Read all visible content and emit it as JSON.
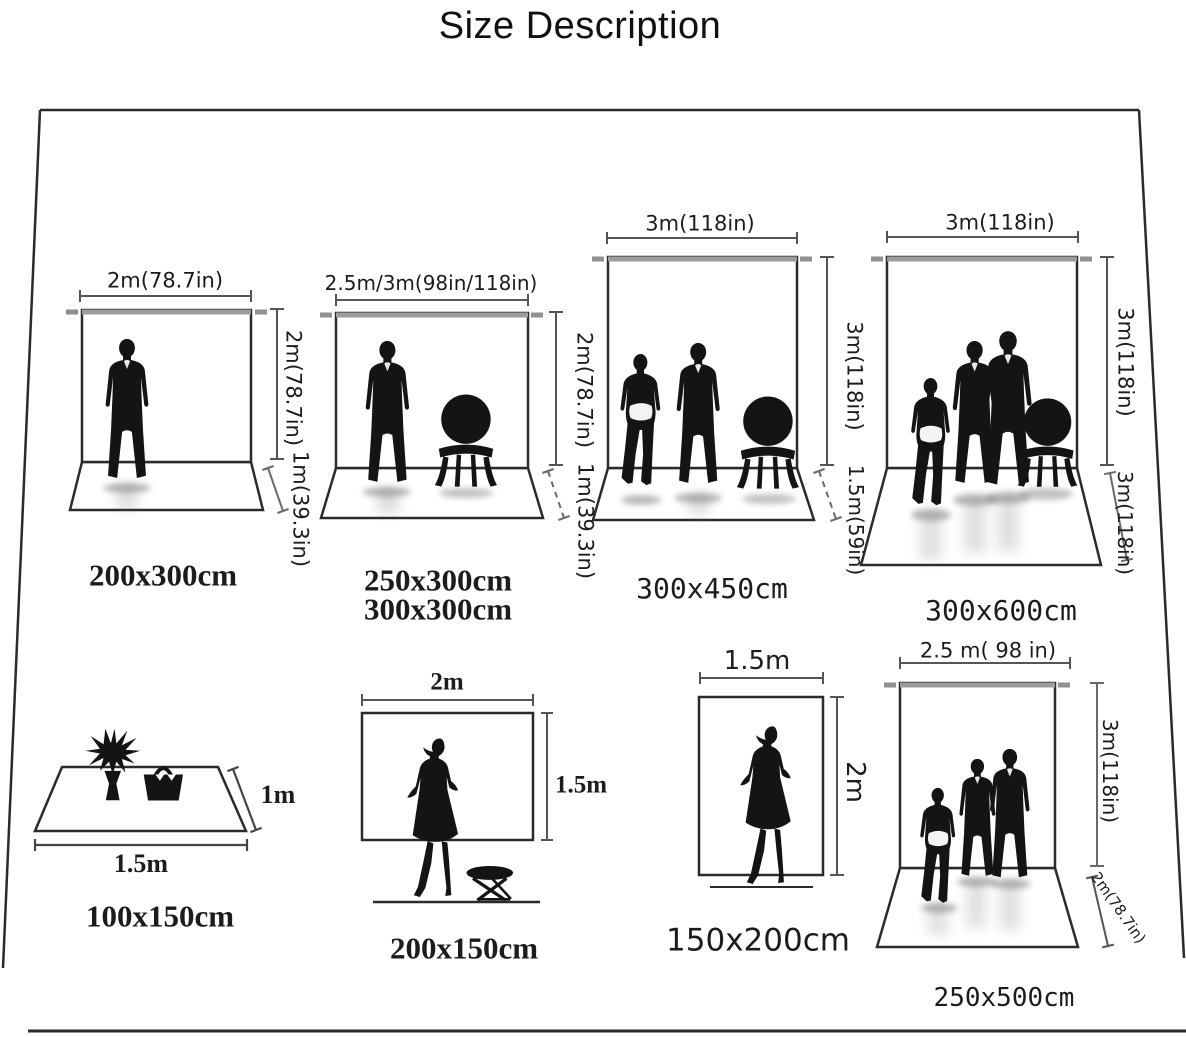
{
  "title": "Size Description",
  "colors": {
    "text": "#1c1c1c",
    "outline": "#2b2b2b",
    "dim_line": "#5a5a5a",
    "rod_gray": "#9c9c9c"
  },
  "diagrams": {
    "d1": {
      "width_label": "2m(78.7in)",
      "height_label": "2m(78.7in)",
      "floor_label": "1m(39.3in)",
      "size_label": "200x300cm"
    },
    "d2": {
      "width_label": "2.5m/3m(98in/118in)",
      "height_label": "2m(78.7in)",
      "floor_label": "1m(39.3in)",
      "size_label_1": "250x300cm",
      "size_label_2": "300x300cm"
    },
    "d3": {
      "width_label": "3m(118in)",
      "height_label": "3m(118in)",
      "floor_label": "1.5m(59in)",
      "size_label": "300x450cm"
    },
    "d4": {
      "width_label": "3m(118in)",
      "height_label": "3m(118in)",
      "floor_label": "3m(118in)",
      "size_label": "300x600cm"
    },
    "d5": {
      "width_label": "1.5m",
      "depth_label": "1m",
      "size_label": "100x150cm"
    },
    "d6": {
      "width_label": "2m",
      "height_label": "1.5m",
      "size_label": "200x150cm"
    },
    "d7": {
      "width_label": "1.5m",
      "height_label": "2m",
      "size_label": "150x200cm"
    },
    "d8": {
      "width_label": "2.5 m( 98 in)",
      "height_label": "3m(118in)",
      "floor_label": "2m(78.7in)",
      "size_label": "250x500cm"
    }
  }
}
